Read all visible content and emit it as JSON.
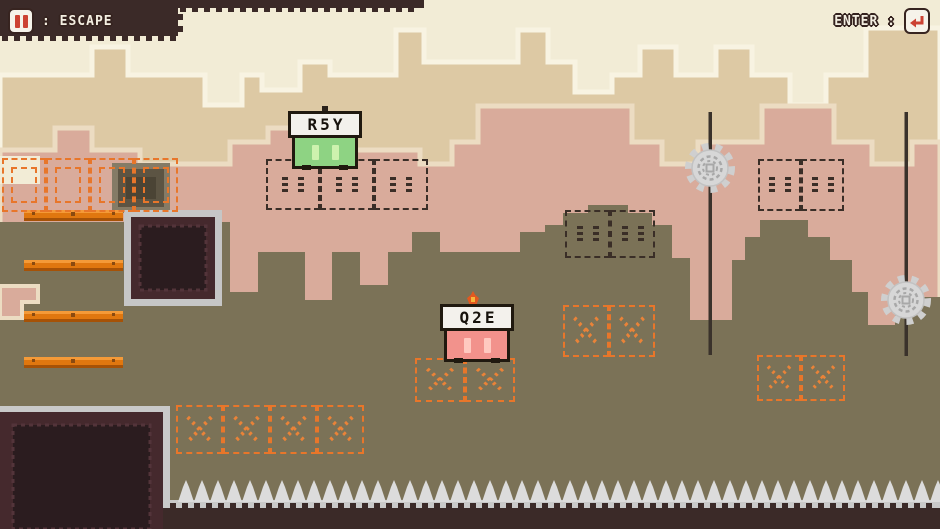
{
  "hud": {
    "left": {
      "icon": "pause-icon",
      "label": ": ESCAPE"
    },
    "right": {
      "label": "ENTER :",
      "icon": "return-icon"
    }
  },
  "players": [
    {
      "label": "R5Y",
      "body_color": "#8ed383",
      "eye_color": "#cdf2ae"
    },
    {
      "label": "Q2E",
      "body_color": "#f2928c",
      "eye_color": "#ffc9c0"
    }
  ],
  "colors": {
    "sky": "#f2ecd6",
    "bg_far": "#ddc9a4",
    "bg_far_outline": "#f8f3e2",
    "bg_mid": "#d9ab9b",
    "bg_mid_outline": "#ecdcc2",
    "ground": "#7b7257",
    "dark": "#3b2a28",
    "platform_orange": "#e0770f",
    "ghost_dark": "#3a2e27",
    "ghost_orange": "#e8762a",
    "hazard_gray": "#dcdcdc",
    "hud_red": "#cc4233"
  }
}
